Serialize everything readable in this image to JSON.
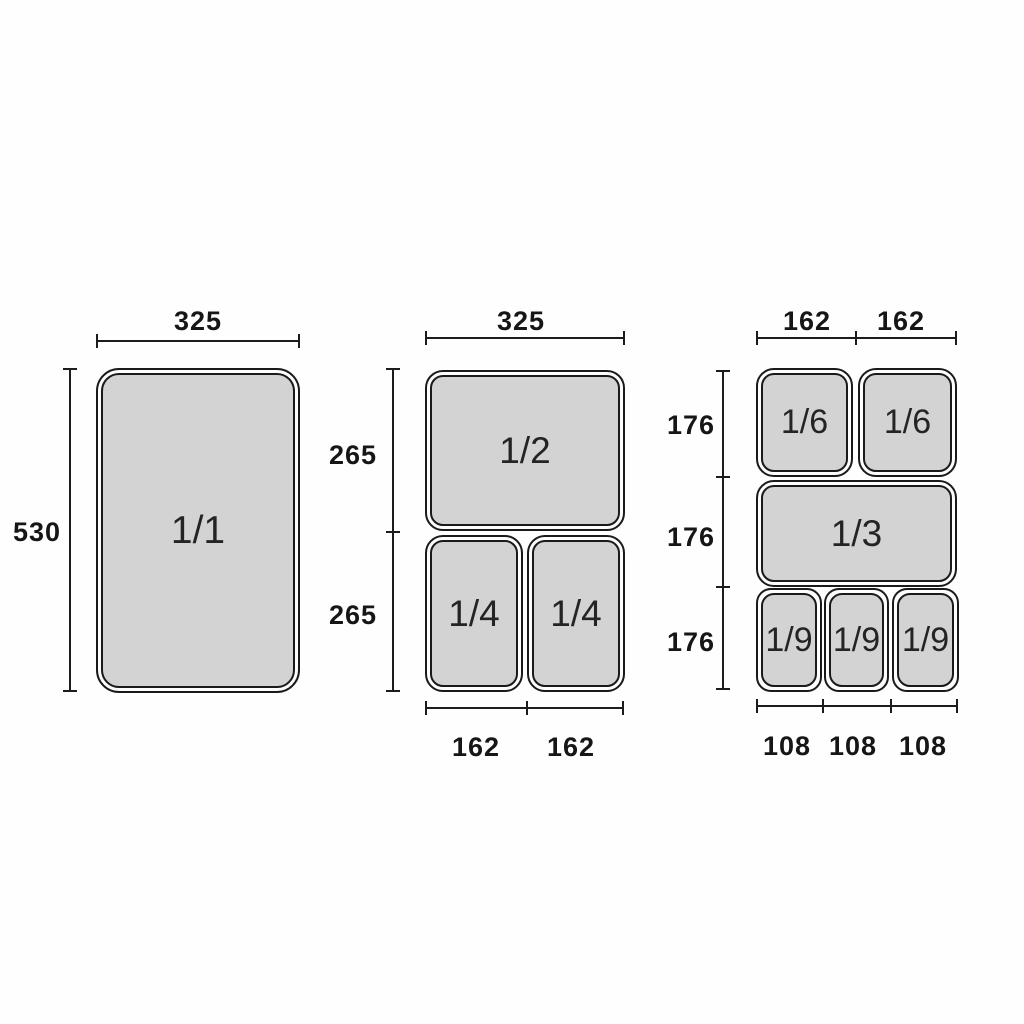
{
  "diagram_title": "Gastronorm pan size diagram",
  "colors": {
    "background": "#fefefe",
    "line": "#1c1c1c",
    "pan_fill": "#d3d3d3",
    "pan_border": "#1a1a1a",
    "text": "#161616"
  },
  "panels": {
    "left": {
      "top_label": "325",
      "side_label": "530",
      "pan_label": "1/1"
    },
    "middle": {
      "top_label": "325",
      "side_labels": [
        "265",
        "265"
      ],
      "bottom_labels": [
        "162",
        "162"
      ],
      "pan_labels": [
        "1/2",
        "1/4",
        "1/4"
      ]
    },
    "right": {
      "top_labels": [
        "162",
        "162"
      ],
      "side_labels": [
        "176",
        "176",
        "176"
      ],
      "bottom_labels": [
        "108",
        "108",
        "108"
      ],
      "pan_labels": [
        "1/6",
        "1/6",
        "1/3",
        "1/9",
        "1/9",
        "1/9"
      ]
    }
  }
}
